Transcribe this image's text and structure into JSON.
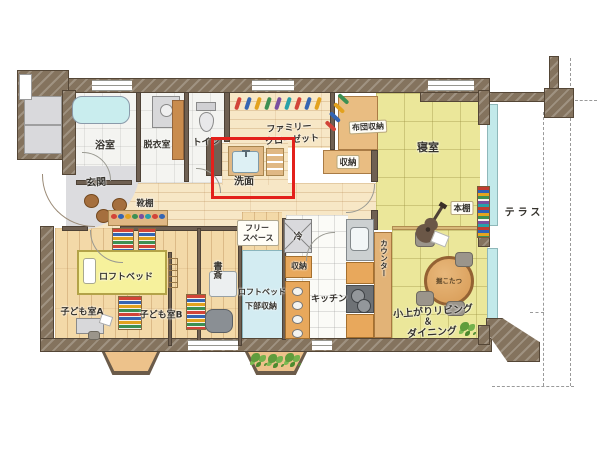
{
  "labels": {
    "bathroom": "浴室",
    "dressing_room": "脱衣室",
    "toilet": "トイレ",
    "washbasin": "洗面",
    "family_closet_line1": "ファミリー",
    "family_closet_line2": "クローゼット",
    "futon_storage": "布団収納",
    "bedroom_storage": "収納",
    "bedroom": "寝室",
    "bookshelf": "本棚",
    "terrace": "テラス",
    "entrance": "玄関",
    "shoe_shelf": "靴棚",
    "loft_bed": "ロフトベッド",
    "kids_room_a": "子ども室A",
    "kids_room_b": "子ども室B",
    "study": "書斎",
    "free_space_line1": "フリー",
    "free_space_line2": "スペース",
    "refrigerator": "冷",
    "kitchen_storage": "収納",
    "loft_bed_storage_line1": "ロフトベッド",
    "loft_bed_storage_line2": "下部収納",
    "kitchen": "キッチン",
    "counter": "カウンター",
    "living_line1": "小上がりリビング",
    "living_line2": "＆",
    "living_line3": "ダイニング",
    "kotatsu": "掘こたつ"
  },
  "highlight": {
    "color": "#e3201b",
    "target": "洗面"
  },
  "palette": {
    "wall": "#84735e",
    "wood_floor": "#f3d9a8",
    "corridor_floor": "#f7e7c6",
    "tatami_yellow": "#ebe79a",
    "storage_orange": "#e9bd82",
    "water_blue": "#c5ecee",
    "loft_storage_blue": "#d3ecf2",
    "entrance_gray": "#dcdcdf"
  }
}
